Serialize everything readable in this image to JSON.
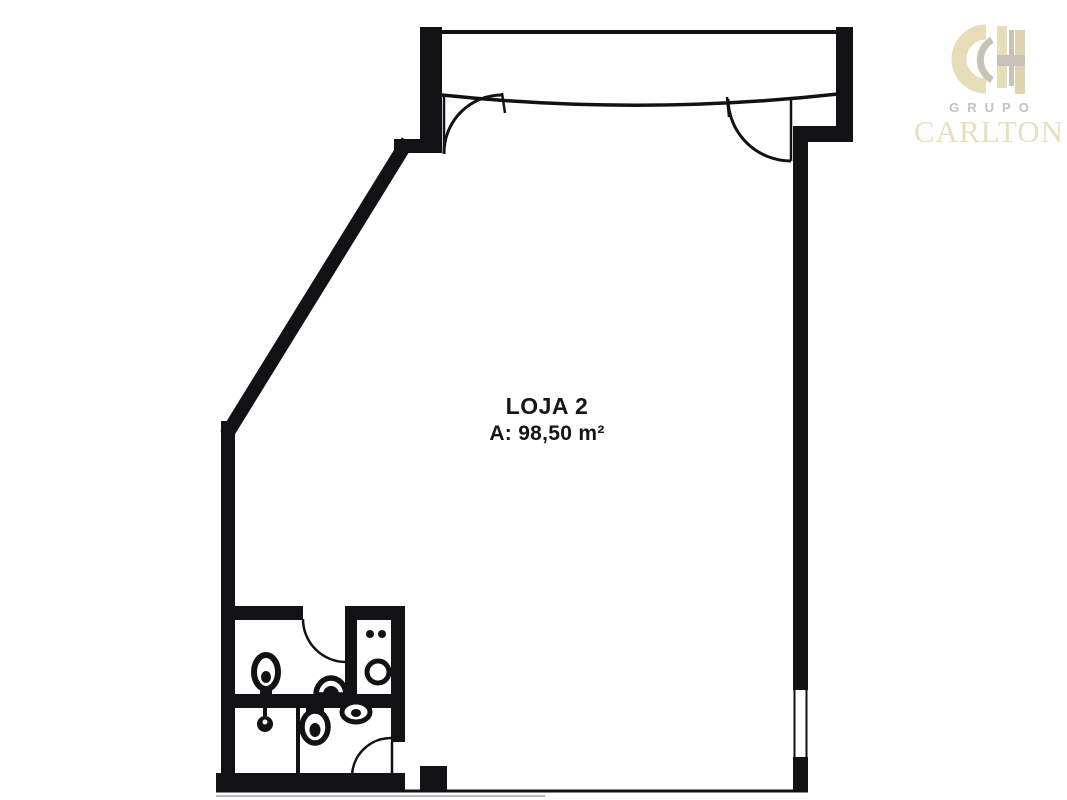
{
  "plan": {
    "unit_label": "LOJA 2",
    "area_label": "A: 98,50 m²",
    "fixtures": [
      "toilet-icon",
      "wall-sink-icon",
      "counter-dots-icon",
      "round-basin-icon",
      "toilet-icon",
      "oval-sink-icon",
      "floor-drain-icon"
    ],
    "doors": [
      "storefront-door-left",
      "storefront-door-right",
      "bathroom-door-top",
      "bathroom-door-bottom"
    ]
  },
  "logo": {
    "monogram": "CH",
    "group_label": "GRUPO",
    "brand_label": "CARLTON"
  },
  "colors": {
    "background": "#ffffff",
    "wall": "#121214",
    "label_text": "#161618",
    "logo_beige": "#e7ddb8",
    "logo_beige_dark": "#ded4ae",
    "logo_gray": "#c6c2b8"
  }
}
